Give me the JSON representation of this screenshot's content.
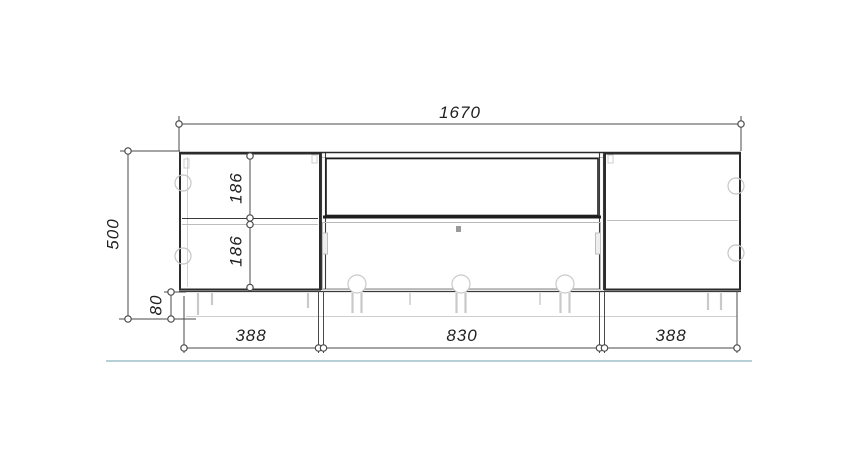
{
  "colors": {
    "background": "#ffffff",
    "outline": "#2b2b2b",
    "panel_edge": "#b8b8b8",
    "hardware": "#c6c6c6",
    "dimension_line": "#4a4a4a",
    "floor_accent_line": "#b7cfd6"
  },
  "dimensions": {
    "total_width_mm": "1670",
    "total_height_mm": "500",
    "plinth_height_mm": "80",
    "left_upper_compartment_mm": "186",
    "left_lower_compartment_mm": "186",
    "left_section_width_mm": "388",
    "middle_section_width_mm": "830",
    "right_section_width_mm": "388"
  }
}
